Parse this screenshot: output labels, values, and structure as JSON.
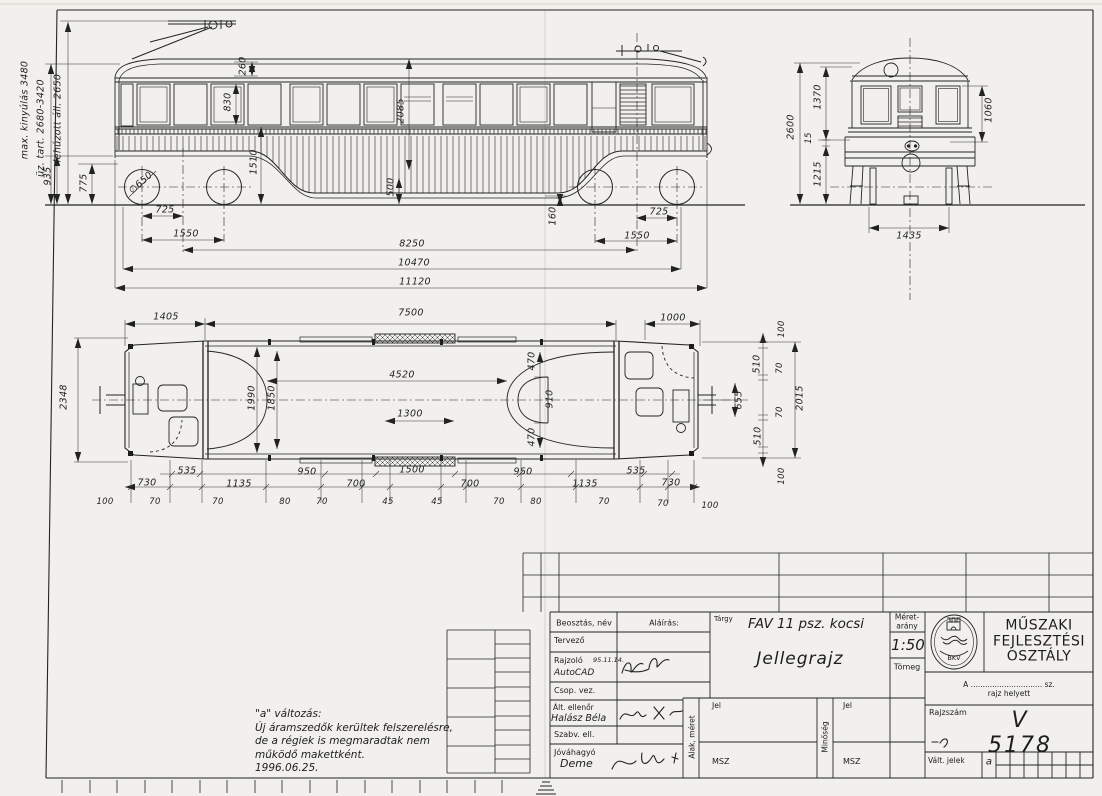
{
  "side": {
    "labels": [
      {
        "t": "max. kinyúlás 3480",
        "x": 25,
        "y": 110,
        "r": -90
      },
      {
        "t": "üz. tart. 2680-3420",
        "x": 41,
        "y": 128,
        "r": -90
      },
      {
        "t": "lehúzott áll. 2650",
        "x": 58,
        "y": 118,
        "r": -90
      },
      {
        "t": "935",
        "x": 48,
        "y": 176,
        "r": -90
      },
      {
        "t": "775",
        "x": 84,
        "y": 183,
        "r": -90
      },
      {
        "t": "∅650",
        "x": 141,
        "y": 183,
        "r": -42
      },
      {
        "t": "260",
        "x": 243,
        "y": 66,
        "r": -90
      },
      {
        "t": "830",
        "x": 228,
        "y": 102,
        "r": -90
      },
      {
        "t": "2085",
        "x": 401,
        "y": 111,
        "r": -90
      },
      {
        "t": "1510",
        "x": 254,
        "y": 162,
        "r": -90
      },
      {
        "t": "500",
        "x": 391,
        "y": 187,
        "r": -90
      },
      {
        "t": "160",
        "x": 553,
        "y": 216,
        "r": -90
      },
      {
        "t": "725",
        "x": 165,
        "y": 210
      },
      {
        "t": "1550",
        "x": 186,
        "y": 234
      },
      {
        "t": "725",
        "x": 659,
        "y": 212
      },
      {
        "t": "1550",
        "x": 637,
        "y": 236
      },
      {
        "t": "8250",
        "x": 412,
        "y": 244
      },
      {
        "t": "10470",
        "x": 414,
        "y": 263
      },
      {
        "t": "11120",
        "x": 415,
        "y": 282
      }
    ]
  },
  "front": {
    "labels": [
      {
        "t": "2600",
        "x": 791,
        "y": 127,
        "r": -90
      },
      {
        "t": "1370",
        "x": 818,
        "y": 97,
        "r": -90
      },
      {
        "t": "15",
        "x": 809,
        "y": 138,
        "r": -90,
        "fs": 8.5
      },
      {
        "t": "1215",
        "x": 818,
        "y": 174,
        "r": -90
      },
      {
        "t": "1060",
        "x": 989,
        "y": 110,
        "r": -90
      },
      {
        "t": "1435",
        "x": 909,
        "y": 236
      }
    ]
  },
  "plan": {
    "labels": [
      {
        "t": "1405",
        "x": 166,
        "y": 317
      },
      {
        "t": "7500",
        "x": 411,
        "y": 313
      },
      {
        "t": "1000",
        "x": 673,
        "y": 318
      },
      {
        "t": "2348",
        "x": 64,
        "y": 397,
        "r": -90
      },
      {
        "t": "1990",
        "x": 252,
        "y": 398,
        "r": -90
      },
      {
        "t": "1850",
        "x": 272,
        "y": 398,
        "r": -90
      },
      {
        "t": "4520",
        "x": 402,
        "y": 375
      },
      {
        "t": "1300",
        "x": 410,
        "y": 414
      },
      {
        "t": "470",
        "x": 532,
        "y": 361,
        "r": -90
      },
      {
        "t": "910",
        "x": 550,
        "y": 399,
        "r": -90
      },
      {
        "t": "470",
        "x": 532,
        "y": 437,
        "r": -90
      },
      {
        "t": "655",
        "x": 739,
        "y": 400,
        "r": -90
      },
      {
        "t": "510",
        "x": 757,
        "y": 364,
        "r": -90
      },
      {
        "t": "70",
        "x": 780,
        "y": 368,
        "r": -90,
        "fs": 8.5
      },
      {
        "t": "70",
        "x": 780,
        "y": 412,
        "r": -90,
        "fs": 8.5
      },
      {
        "t": "510",
        "x": 758,
        "y": 436,
        "r": -90
      },
      {
        "t": "100",
        "x": 782,
        "y": 329,
        "r": -90,
        "fs": 8.5
      },
      {
        "t": "100",
        "x": 782,
        "y": 476,
        "r": -90,
        "fs": 8.5
      },
      {
        "t": "2015",
        "x": 800,
        "y": 398,
        "r": -90
      },
      {
        "t": "535",
        "x": 187,
        "y": 471
      },
      {
        "t": "730",
        "x": 147,
        "y": 483
      },
      {
        "t": "1135",
        "x": 239,
        "y": 484
      },
      {
        "t": "950",
        "x": 307,
        "y": 472
      },
      {
        "t": "700",
        "x": 356,
        "y": 484
      },
      {
        "t": "1500",
        "x": 412,
        "y": 470
      },
      {
        "t": "700",
        "x": 470,
        "y": 484
      },
      {
        "t": "950",
        "x": 523,
        "y": 472
      },
      {
        "t": "1135",
        "x": 585,
        "y": 484
      },
      {
        "t": "535",
        "x": 636,
        "y": 471
      },
      {
        "t": "730",
        "x": 671,
        "y": 483
      },
      {
        "t": "100",
        "x": 105,
        "y": 502,
        "fs": 8.5
      },
      {
        "t": "70",
        "x": 155,
        "y": 502,
        "fs": 8.5
      },
      {
        "t": "70",
        "x": 218,
        "y": 502,
        "fs": 8.5
      },
      {
        "t": "80",
        "x": 285,
        "y": 502,
        "fs": 8.5
      },
      {
        "t": "70",
        "x": 322,
        "y": 502,
        "fs": 8.5
      },
      {
        "t": "45",
        "x": 388,
        "y": 502,
        "fs": 8.5
      },
      {
        "t": "45",
        "x": 437,
        "y": 502,
        "fs": 8.5
      },
      {
        "t": "70",
        "x": 499,
        "y": 502,
        "fs": 8.5
      },
      {
        "t": "80",
        "x": 536,
        "y": 502,
        "fs": 8.5
      },
      {
        "t": "70",
        "x": 604,
        "y": 502,
        "fs": 8.5
      },
      {
        "t": "70",
        "x": 663,
        "y": 504,
        "fs": 8.5
      },
      {
        "t": "100",
        "x": 710,
        "y": 506,
        "fs": 8.5
      }
    ]
  },
  "title_block": {
    "header_col1": "Beosztás, név",
    "header_col2": "Aláírás:",
    "row_tervezo": "Tervező",
    "row_rajzolo": "Rajzoló",
    "rajzolo_date": "95.11.14.",
    "rajzolo_name": "AutoCAD",
    "row_csop_vez": "Csop. vez.",
    "row_alt_ellenor": "Ált. ellenőr",
    "alt_ellenor_name": "Halász Béla",
    "row_szabv_ell": "Szabv. ell.",
    "row_jovahagyo": "Jóváhagyó",
    "jovahagyo_sig": "Deme",
    "subject_label": "Tárgy",
    "subject": "FAV 11 psz. kocsi",
    "drawing_title": "Jellegrajz",
    "scale_label": "Méret-\narány",
    "scale_value": "1:50",
    "mass_label": "Tömeg",
    "shape_size_label": "Alak, méret",
    "quality_label": "Minőség",
    "jel_label": "Jel",
    "msz_label": "MSZ",
    "org_name": "MŰSZAKI\nFEJLESZTÉSI\nOSZTÁLY",
    "org_logo": "BKV",
    "replaces_label": "A .............................. sz. rajz helyett",
    "number_label": "Rajzszám",
    "number": "V 5178",
    "change_label": "Vált. jelek",
    "change_letter": "a"
  },
  "note_text": "\"a\" változás:\nÚj áramszedők kerültek felszerelésre,\nde a régiek is megmaradtak nem\nműködő makettként.\n1996.06.25."
}
